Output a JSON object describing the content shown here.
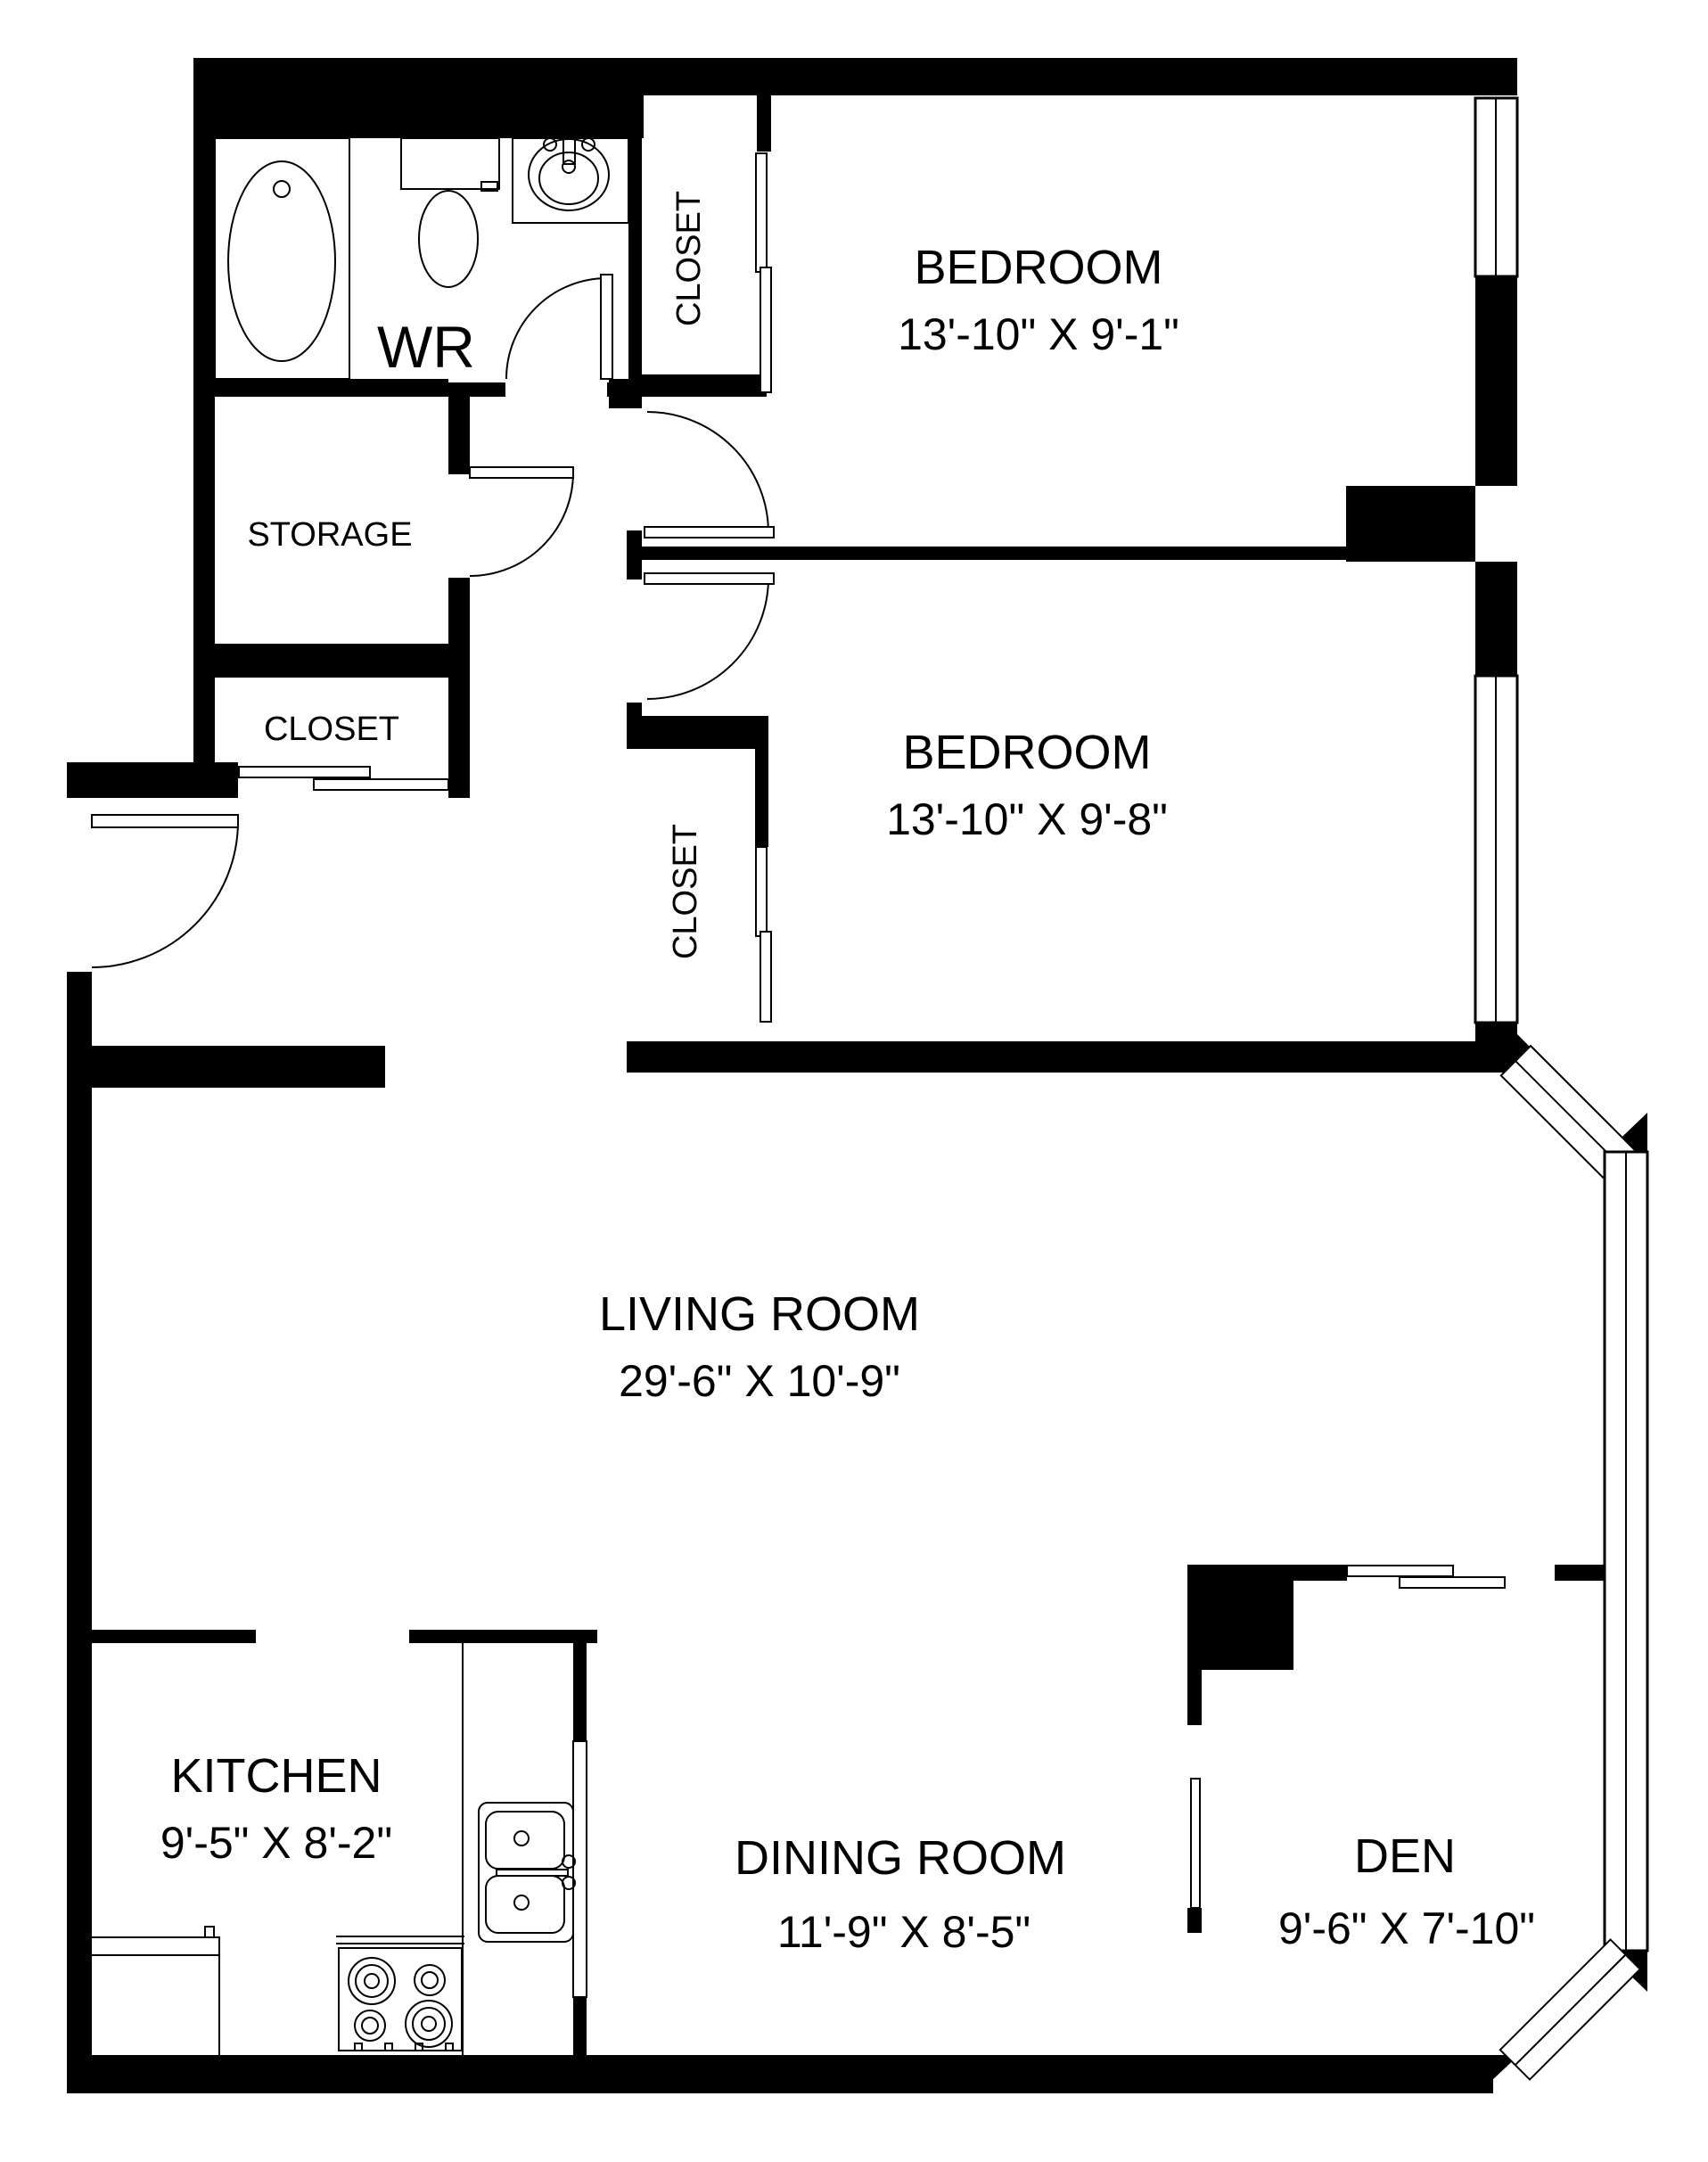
{
  "plan": {
    "colors": {
      "wall": "#000000",
      "background": "#ffffff",
      "line": "#000000"
    },
    "rooms": {
      "wr": {
        "label": "WR"
      },
      "storage": {
        "label": "STORAGE"
      },
      "hall_closet": {
        "label": "CLOSET"
      },
      "bedroom1_closet": {
        "label": "CLOSET"
      },
      "bedroom2_closet": {
        "label": "CLOSET"
      },
      "bedroom1": {
        "label": "BEDROOM",
        "dimensions": "13'-10\" X 9'-1\""
      },
      "bedroom2": {
        "label": "BEDROOM",
        "dimensions": "13'-10\" X 9'-8\""
      },
      "living": {
        "label": "LIVING ROOM",
        "dimensions": "29'-6\" X 10'-9\""
      },
      "kitchen": {
        "label": "KITCHEN",
        "dimensions": "9'-5\" X 8'-2\""
      },
      "dining": {
        "label": "DINING ROOM",
        "dimensions": "11'-9\" X 8'-5\""
      },
      "den": {
        "label": "DEN",
        "dimensions": "9'-6\" X 7'-10\""
      }
    }
  }
}
